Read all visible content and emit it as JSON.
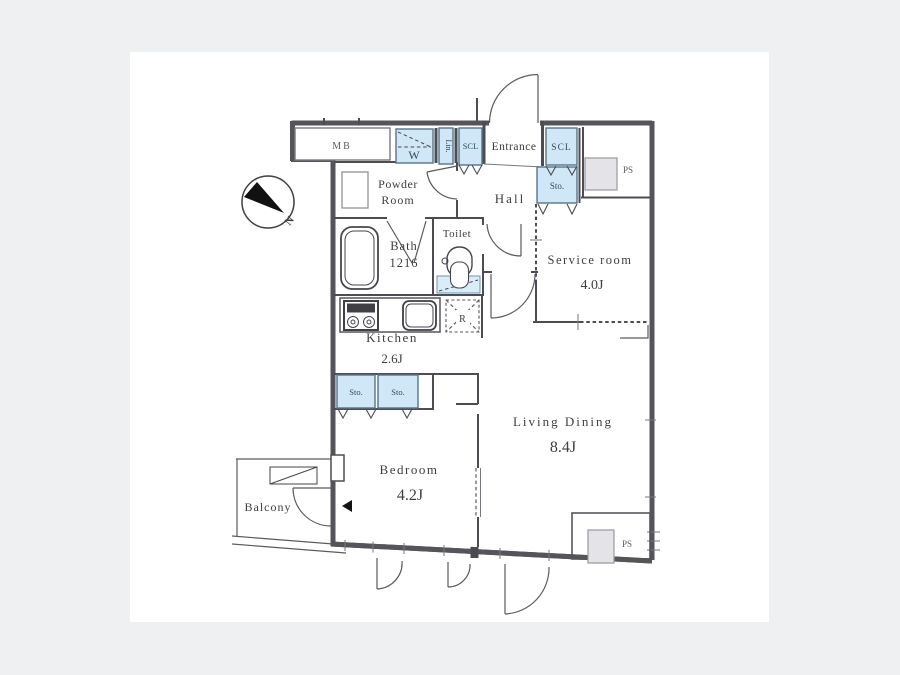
{
  "plan": {
    "type": "apartment-floor-plan",
    "background_color": "#eff0f2",
    "paper_color": "#ffffff",
    "wall_color": "#54545a",
    "closet_fill_color": "#cfe7f6",
    "shaft_fill_color": "#e4e4e8"
  },
  "rooms": {
    "entrance": {
      "label": "Entrance"
    },
    "hall": {
      "label": "Hall"
    },
    "powder_room": {
      "label_line1": "Powder",
      "label_line2": "Room"
    },
    "bath": {
      "label": "Bath",
      "size": "1216"
    },
    "toilet": {
      "label": "Toilet"
    },
    "kitchen": {
      "label": "Kitchen",
      "area": "2.6J"
    },
    "service_room": {
      "label": "Service room",
      "area": "4.0J"
    },
    "living_dining": {
      "label": "Living Dining",
      "area": "8.4J"
    },
    "bedroom": {
      "label": "Bedroom",
      "area": "4.2J"
    },
    "balcony": {
      "label": "Balcony"
    }
  },
  "storage": {
    "washer": "W",
    "linen": "Lin.",
    "scl_hall": "SCL",
    "scl_entrance": "SCL",
    "sto_entrance": "Sto.",
    "sto_bedroom_left": "Sto.",
    "sto_bedroom_right": "Sto."
  },
  "fixtures": {
    "meter_box": "MB",
    "refrigerator": "R",
    "pipe_shaft_top": "PS",
    "pipe_shaft_bottom": "PS"
  },
  "compass": {
    "north": "N"
  }
}
